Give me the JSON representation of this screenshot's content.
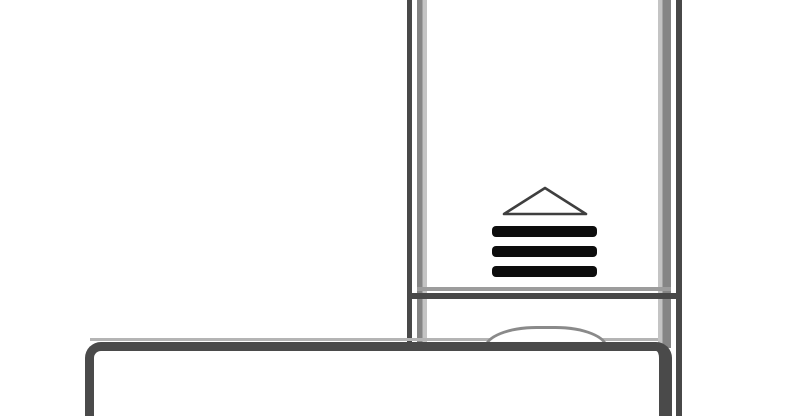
{
  "figure": {
    "figure_type": "technical-line-drawing",
    "background_color": "#ffffff",
    "colors": {
      "outline_dark": "#484848",
      "outline_gray": "#858585",
      "outline_gray_light": "#c4c4c4",
      "inner_line_gray": "#9c9c9c",
      "highlight_gray": "#b4b4b4",
      "vent_slat_black": "#0d0d0d",
      "triangle_stroke": "#3f3f3f",
      "dome_stroke": "#8a8a8a",
      "base_outline": "#4a4a4a"
    },
    "vent_grille": {
      "slat_count": 3,
      "hood_shape": "triangle-outline"
    }
  }
}
